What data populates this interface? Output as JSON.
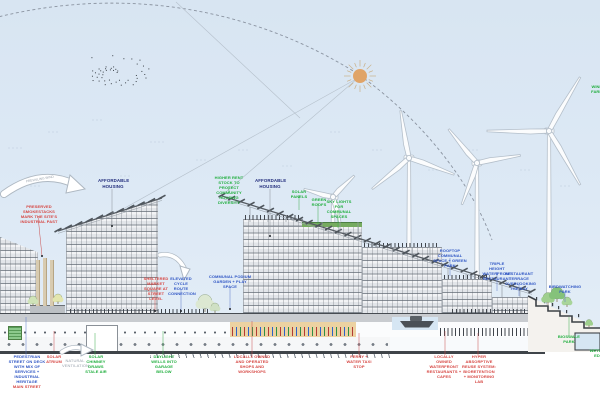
{
  "colors": {
    "sky": "#dde9f5",
    "sun": "#e0a468",
    "turbine_stroke": "#b4bfca",
    "canopy": "#565c63",
    "chimney": "#d8cbb0",
    "water": "#d6e6f3",
    "terrain": "#3d4247",
    "promenade": "#ecd2a2",
    "label_green": "#1fae3d",
    "label_red": "#d64541",
    "label_blue": "#2f56c4",
    "label_navy": "#232e7d"
  },
  "annotations": {
    "prevailing_wind": "PREVAILING WIND",
    "smokestacks": "PRESERVED SMOKESTACKS MARK THE SITE'S INDUSTRIAL PAST",
    "affordable_housing_1": "AFFORDABLE HOUSING",
    "higher_rent": "HIGHER RENT STOCK TO PROTECT COMMUNITY HOUSING DIVERSITY",
    "affordable_housing_2": "AFFORDABLE HOUSING",
    "solar_panels": "SOLAR PANELS",
    "green_roofs": "GREEN ROOFS",
    "skylights": "SKY LIGHTS FOR COMMUNAL SPACES",
    "wind_farm_edge": "WIND FARM",
    "rooftop_communal": "ROOFTOP COMMUNAL SPACE + GREEN PARK",
    "waterfront_restaurant": "TRIPLE HEIGHT WATERFRONT RESTAURANT",
    "restaurant_terrace": "RESTAURANT TERRACE OVERLOOKING THE BAY",
    "birdwatching_park": "BIRDWATCHING PARK",
    "market_square": "SHELTERED MARKET SQUARE AT STREET LEVEL",
    "cycle_route": "ELEVATED CYCLE ROUTE CONNECTION",
    "podium_garden": "COMMUNAL PODIUM GARDEN + PLAY SPACE",
    "ped_street": "PEDESTRIAN STREET ON DECK WITH MIX OF SERVICES + INDUSTRIAL HERITAGE",
    "ped_street_sub": "MAIN STREET",
    "solar_atrium": "SOLAR ATRIUM",
    "ventilation": "NATURAL VENTILATION",
    "stack_vent": "SOLAR CHIMNEY DRAWS STALE AIR",
    "daylight_wells": "DAYLIGHT WELLS INTO GARAGE BELOW",
    "local_shops": "LOCALLY OWNED AND OPERATED SHOPS AND WORKSHOPS",
    "ferry_stop": "FERRY + WATER TAXI STOP",
    "waterfront_restaurants": "LOCALLY OWNED WATERFRONT RESTAURANTS + CAFES",
    "water_system": "HYPER ABSORPTIVE REUSE SYSTEM: BIORETENTION + MONITORING LAB",
    "bioswale_park": "BIOSWALE PARK",
    "wetland_edge": "WETLAND EDGE"
  }
}
